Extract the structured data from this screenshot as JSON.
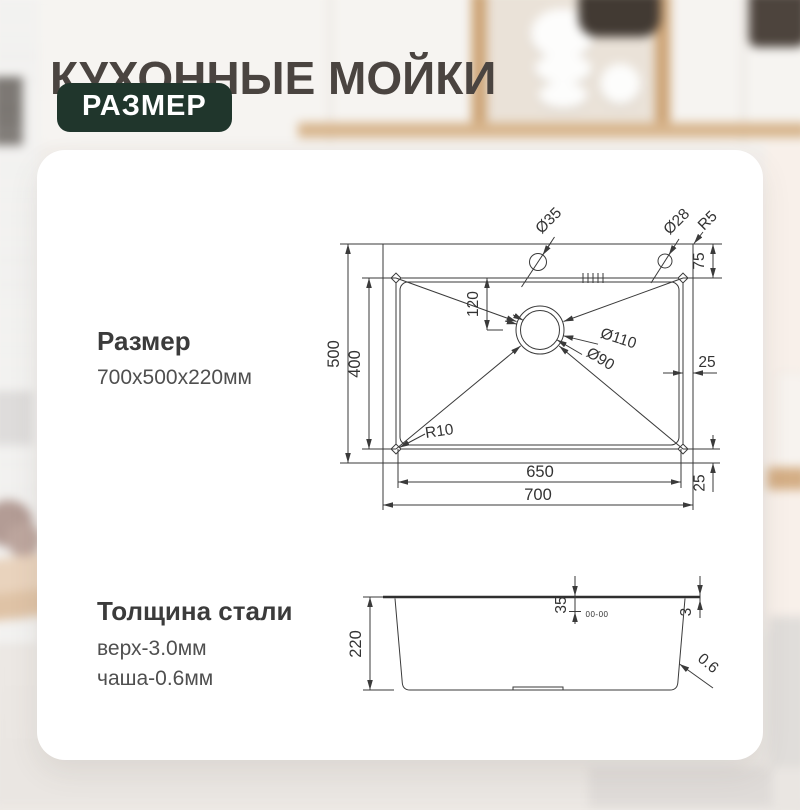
{
  "header": {
    "title": "КУХОННЫЕ МОЙКИ",
    "badge": "РАЗМЕР"
  },
  "size_info": {
    "heading": "Размер",
    "value": "700x500x220мм"
  },
  "thickness_info": {
    "heading": "Толщина стали",
    "top": "верх-3.0мм",
    "bowl": "чаша-0.6мм"
  },
  "top_view": {
    "labels": {
      "hole_faucet": "Ø35",
      "hole_soap": "Ø28",
      "outer_corner_radius": "R5",
      "deck_top": "75",
      "drain_from_top": "120",
      "drain_outer": "Ø110",
      "drain_inner": "Ø90",
      "outer_height": "500",
      "bowl_height": "400",
      "bowl_corner_radius": "R10",
      "deck_right": "25",
      "bowl_width": "650",
      "outer_width": "700",
      "deck_bottom": "25"
    }
  },
  "side_view": {
    "labels": {
      "depth": "220",
      "ledge": "35",
      "rim_thickness": "3",
      "wall_thickness": "0.6",
      "brand_mark": "00-00"
    }
  },
  "colors": {
    "badge_bg": "#20362c",
    "title_text": "#4a4440",
    "drawing_line": "#3a3a3a",
    "card_bg": "#ffffff"
  }
}
